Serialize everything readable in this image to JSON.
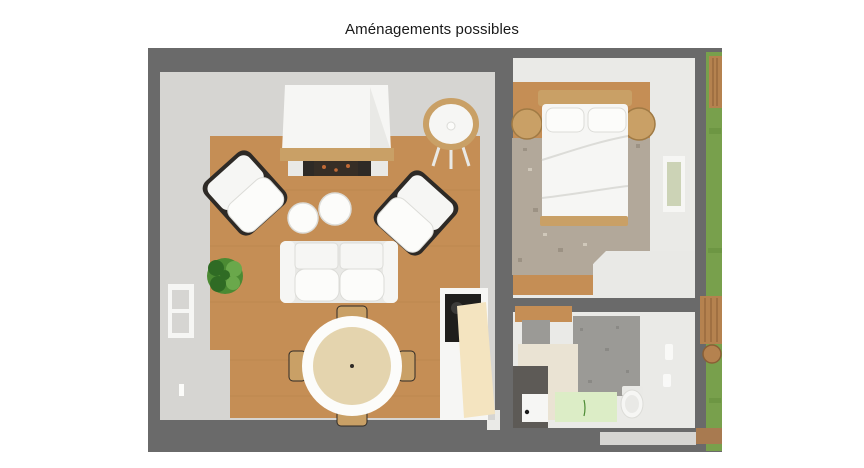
{
  "title": {
    "text": "Aménagements possibles"
  },
  "figure": {
    "type": "3d-floor-plan-top-view",
    "rooms": [
      "living-room",
      "bedroom",
      "bathroom",
      "garden-strip"
    ],
    "items": {
      "living_room": [
        "fireplace-hood",
        "wood-mantel",
        "firebox",
        "round-cradle",
        "armchair",
        "armchair",
        "pouf",
        "pouf",
        "two-seat-sofa",
        "potted-plant",
        "round-dining-table",
        "dining-chair",
        "dining-chair",
        "dining-chair",
        "dining-chair",
        "kitchen-counter",
        "cooktop",
        "open-door-panel",
        "wall-window"
      ],
      "bedroom": [
        "double-bed",
        "headboard",
        "pillow",
        "pillow",
        "round-nightstand",
        "round-nightstand",
        "area-rug",
        "wall-window",
        "dresser"
      ],
      "bathroom": [
        "toilet",
        "door",
        "partition-wall",
        "green-floor-mat"
      ],
      "exterior": [
        "grass-lawn",
        "wood-fence",
        "wood-fence",
        "tree-stump",
        "dirt-path"
      ]
    }
  },
  "colors": {
    "page_bg": "#ffffff",
    "title": "#1a1a1a",
    "surround": "#6a6a6a",
    "wall_light": "#d6d5d2",
    "wall_white": "#eaeae7",
    "floor_wood": "#c58e55",
    "plank_line": "#ad7a45",
    "furniture_wood": "#c9a066",
    "wood_edge": "#a07a44",
    "white_soft": "#f6f6f4",
    "white_bright": "#fcfcfa",
    "white_base": "#e9e9e6",
    "cushion_edge": "#dcdcd8",
    "frame_dark": "#2e2a26",
    "firebox": "#362e26",
    "ember": "#c06a36",
    "carpet": "#b2a89a",
    "carpet_speck_dark": "#857b6d",
    "carpet_speck_light": "#ddd6c8",
    "tablecloth": "#e4d4ae",
    "cooktop": "#1f1e1c",
    "burner": "#3c3b39",
    "cream_panel": "#f4e4c0",
    "cream_wall": "#eae3d3",
    "bath_gray": "#9b9a96",
    "bath_speck": "#7f7e7a",
    "bath_green": "#dcedc6",
    "shadow_dark": "#5d5a56",
    "pane_green": "#ccd3b6",
    "grass": "#78a04c",
    "grass_dark": "#5f8a3a",
    "fence": "#b5824f",
    "fence_line": "#8a5f35",
    "dirt": "#a87a50",
    "plant_dark": "#2f6b24",
    "plant_mid": "#4b8a33",
    "plant_light": "#6aa84b",
    "handle_black": "#1a1a1a"
  }
}
